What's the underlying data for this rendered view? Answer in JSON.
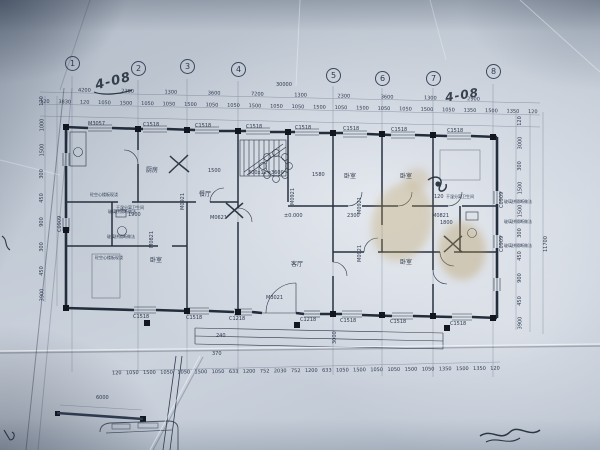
{
  "handwriting": {
    "top_left": "4-08",
    "top_right": "4-08"
  },
  "axes": [
    "1",
    "2",
    "3",
    "4",
    "5",
    "6",
    "7",
    "8"
  ],
  "dims": {
    "overall_top": "30000",
    "top_bays": [
      "4200",
      "2300",
      "1300",
      "3600",
      "7200",
      "1300",
      "2300",
      "3600",
      "1300",
      "2900"
    ],
    "top_detail": [
      "120",
      "3830",
      "120",
      "1050",
      "1500",
      "1050",
      "1050",
      "1500",
      "1050",
      "1050",
      "1500",
      "1050",
      "1050",
      "1500",
      "1050",
      "1500",
      "1050",
      "1050",
      "1500",
      "1050",
      "1350",
      "1500",
      "1350",
      "120"
    ],
    "bottom_detail": [
      "120",
      "1050",
      "1500",
      "1050",
      "1050",
      "1500",
      "1050",
      "633",
      "1200",
      "752",
      "2030",
      "752",
      "1200",
      "633",
      "1050",
      "1500",
      "1050",
      "1050",
      "1500",
      "1050",
      "1350",
      "1500",
      "1350",
      "120"
    ],
    "left_col": [
      "120",
      "1000",
      "1500",
      "300",
      "450",
      "900",
      "300",
      "450",
      "3900"
    ],
    "right_col": [
      "120",
      "3000",
      "300",
      "1500",
      "1500",
      "300",
      "450",
      "900",
      "450",
      "3900"
    ],
    "right_overall": "11700",
    "stair_note": "300x12=3600",
    "stair_width": "1580",
    "hall_width": "1500",
    "level": "±0.000",
    "dining_width": "2300",
    "bath_left": "1900",
    "bath_right": "1800",
    "bath_offset": "120",
    "porch_width": "240",
    "porch_step": "370",
    "porch_depth": "3000",
    "garage": "6000"
  },
  "windows_top": [
    "M3057",
    "C1518",
    "C1518",
    "C1518",
    "C1518",
    "C1518",
    "C1518",
    "C1518"
  ],
  "windows_bottom": [
    "C1518",
    "C1518",
    "C1218",
    "M3021",
    "C1218",
    "C1518",
    "C1518",
    "C1518"
  ],
  "interior_labels": [
    "M0921",
    "M0921",
    "M0921",
    "M0921",
    "M0821",
    "M0821",
    "M0621",
    "C0909",
    "C0909",
    "C0909"
  ],
  "rooms": [
    "厨房",
    "餐厅",
    "客厅",
    "卧室",
    "卧室",
    "卧室",
    "卧室"
  ],
  "bath_label": "干湿分离卫生间",
  "annotations_left": [
    "砼空心楼板现浇",
    "玻璃拼隔断做法",
    "玻璃拼隔断做法",
    "砼空心楼板现浇"
  ],
  "annotations_right": [
    "玻璃拼隔断做法",
    "玻璃拼隔断做法",
    "玻璃拼隔断做法"
  ],
  "colors": {
    "ink": "#2d3a4f",
    "wall": "#232e3d",
    "pen": "#1d2836",
    "paper": "#c2cad5",
    "stain": "#b89a56"
  }
}
